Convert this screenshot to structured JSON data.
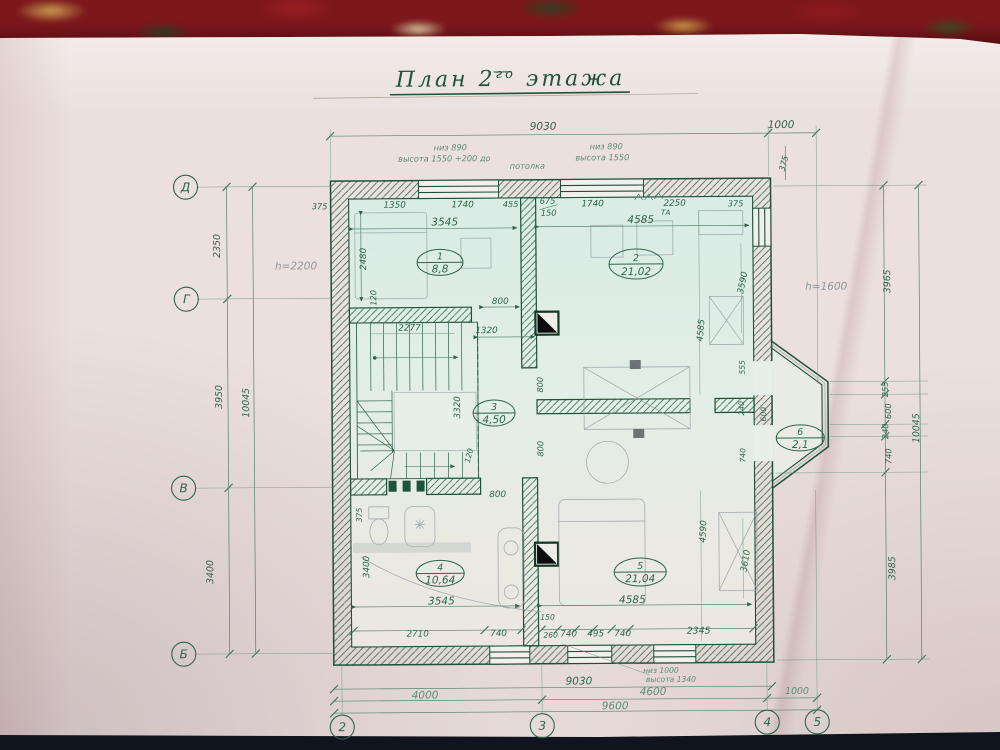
{
  "photo": {
    "carpet_color": "#7c171c",
    "paper_color": "#ebe0de",
    "ink_color": "#2e6549",
    "pencil_color": "#8f969d"
  },
  "title": {
    "part1": "План 2",
    "sup": "го",
    "part2": " этажа"
  },
  "axes": {
    "left": [
      "Д",
      "Г",
      "В",
      "Б"
    ],
    "bottom": [
      "2",
      "3",
      "4",
      "5"
    ]
  },
  "rooms": [
    {
      "num": "1",
      "area": "8,8"
    },
    {
      "num": "2",
      "area": "21,02"
    },
    {
      "num": "3",
      "area": "4,50"
    },
    {
      "num": "4",
      "area": "10,64"
    },
    {
      "num": "5",
      "area": "21,04"
    },
    {
      "num": "6",
      "area": "2,1"
    }
  ],
  "notes": {
    "win_left_1": "низ 890",
    "win_left_2": "высота 1550 +200 до",
    "win_left_3": "потолка",
    "win_right_1": "низ 890",
    "win_right_2": "высота 1550",
    "win_bottom_1": "низ 1000",
    "win_bottom_2": "высота 1340",
    "h_left": "h=2200",
    "h_right": "h=1600",
    "ta": "ТА"
  },
  "dims": {
    "n9030": "9030",
    "n1000": "1000",
    "n375": "375",
    "n2350": "2350",
    "n3950": "3950",
    "n10045": "10045",
    "n3400": "3400",
    "n3965": "3965",
    "n255": "255",
    "n600": "600",
    "n740": "740",
    "n3985": "3985",
    "n4000": "4000",
    "n4600": "4600",
    "n9600": "9600",
    "n1350": "1350",
    "n1740": "1740",
    "n455": "455",
    "n675": "675",
    "n150": "150",
    "n2250": "2250",
    "n3545": "3545",
    "n4585": "4585",
    "n2480": "2480",
    "n120": "120",
    "n800": "800",
    "n1320": "1320",
    "n2277": "2277",
    "n3320": "3320",
    "n3590": "3590",
    "n4590": "4590",
    "n3610": "3610",
    "n2710": "2710",
    "n260": "260",
    "n495": "495",
    "n2345": "2345",
    "n555": "555",
    "n240": "240"
  }
}
